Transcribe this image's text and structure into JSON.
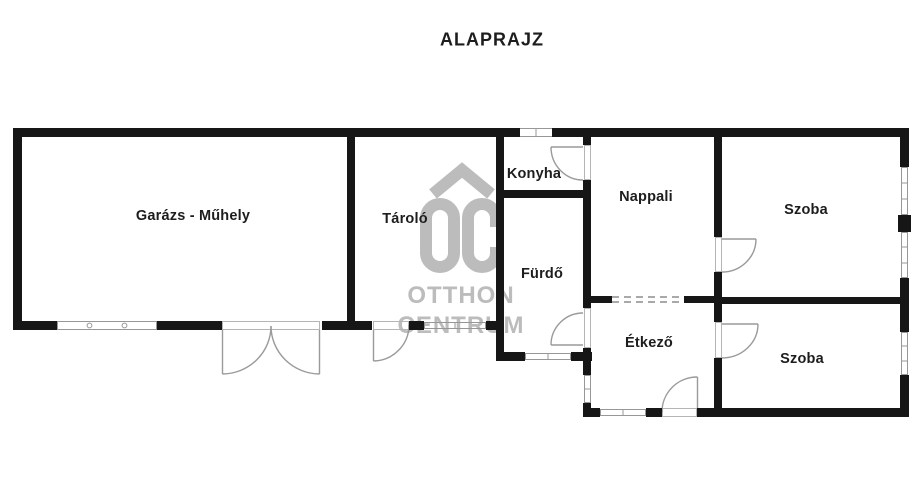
{
  "title": "ALAPRAJZ",
  "watermark": {
    "logo_text": "OC",
    "line1": "OTTHON",
    "line2": "CENTRUM",
    "color": "#bcbcbc"
  },
  "rooms": [
    {
      "name": "Garázs - Műhely"
    },
    {
      "name": "Tároló"
    },
    {
      "name": "Konyha"
    },
    {
      "name": "Fürdő"
    },
    {
      "name": "Nappali"
    },
    {
      "name": "Szoba"
    },
    {
      "name": "Étkező"
    },
    {
      "name": "Szoba"
    }
  ],
  "colors": {
    "wall": "#161616",
    "opening": "#979797",
    "label": "#1d1d1d"
  }
}
